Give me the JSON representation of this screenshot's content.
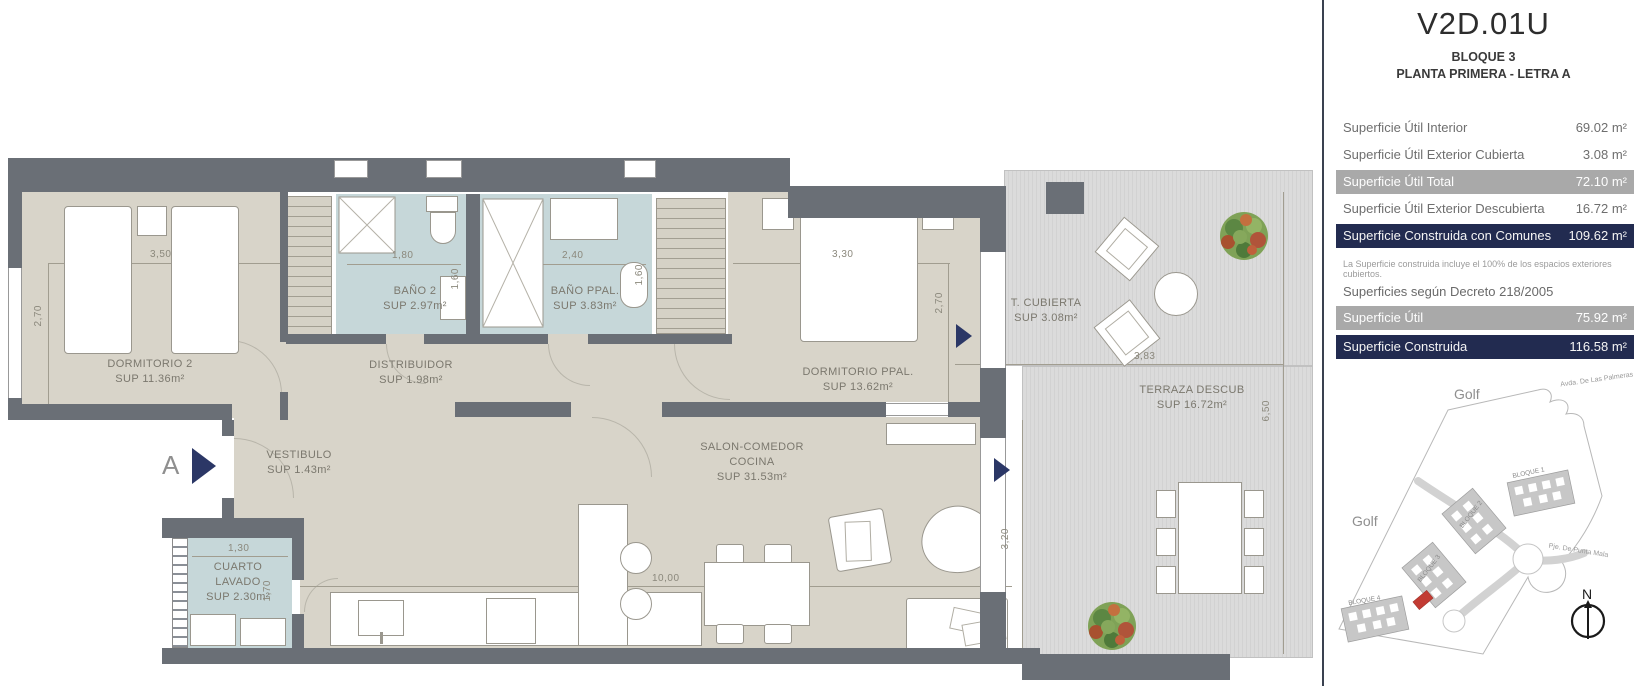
{
  "colors": {
    "accent_navy": "#222b50",
    "band_gray": "#a9a9a9",
    "wall_gray": "#6a6f76",
    "unit_red": "#c23b33",
    "bath_blue": "#c6d7d9",
    "floor_beige": "#d8d4c9"
  },
  "panel": {
    "title": "V2D.01U",
    "block": "BLOQUE 3",
    "floor_line": "PLANTA PRIMERA - LETRA A",
    "rows": [
      {
        "label": "Superficie Útil Interior",
        "value": "69.02 m²"
      },
      {
        "label": "Superficie Útil Exterior Cubierta",
        "value": "3.08 m²"
      },
      {
        "label": "Superficie Útil Total",
        "value": "72.10 m²"
      },
      {
        "label": "Superficie Útil Exterior Descubierta",
        "value": "16.72 m²"
      },
      {
        "label": "Superficie Construida con Comunes",
        "value": "109.62 m²"
      }
    ],
    "note": "La Superficie construida incluye el 100% de los espacios exteriores cubiertos.",
    "decree_heading": "Superficies según Decreto 218/2005",
    "decree_rows": [
      {
        "label": "Superficie Útil",
        "value": "75.92 m²"
      },
      {
        "label": "Superficie Construida",
        "value": "116.58 m²"
      }
    ]
  },
  "sitemap": {
    "golf_top": "Golf",
    "golf_left": "Golf",
    "street_top": "Avda. De Las Palmeras",
    "street_right": "Pje. De Punta Mala",
    "block1": "BLOQUE 1",
    "block2": "BLOQUE 2",
    "block3": "BLOQUE 3",
    "block4": "BLOQUE 4",
    "north": "N"
  },
  "plan": {
    "entrance_letter": "A",
    "rooms": {
      "dorm2": {
        "name": "DORMITORIO 2",
        "sup": "SUP 11.36m²"
      },
      "distribuidor": {
        "name": "DISTRIBUIDOR",
        "sup": "SUP 1.98m²"
      },
      "bano2": {
        "name": "BAÑO 2",
        "sup": "SUP 2.97m²"
      },
      "banoppal": {
        "name": "BAÑO PPAL.",
        "sup": "SUP 3.83m²"
      },
      "dormppal": {
        "name": "DORMITORIO PPAL.",
        "sup": "SUP 13.62m²"
      },
      "vestibulo": {
        "name": "VESTIBULO",
        "sup": "SUP 1.43m²"
      },
      "lavado": {
        "name1": "CUARTO",
        "name2": "LAVADO",
        "sup": "SUP 2.30m²"
      },
      "salon": {
        "name1": "SALON-COMEDOR",
        "name2": "COCINA",
        "sup": "SUP 31.53m²"
      },
      "tcubierta": {
        "name": "T. CUBIERTA",
        "sup": "SUP 3.08m²"
      },
      "terraza": {
        "name": "TERRAZA DESCUB",
        "sup": "SUP 16.72m²"
      }
    },
    "dims": {
      "d350": "3,50",
      "d270l": "2,70",
      "d180": "1,80",
      "d160a": "1,60",
      "d240": "2,40",
      "d160b": "1,60",
      "d330": "3,30",
      "d270r": "2,70",
      "d383": "3,83",
      "d650": "6,50",
      "d130": "1,30",
      "d170": "1,70",
      "d1000": "10,00",
      "d320": "3,20"
    }
  }
}
